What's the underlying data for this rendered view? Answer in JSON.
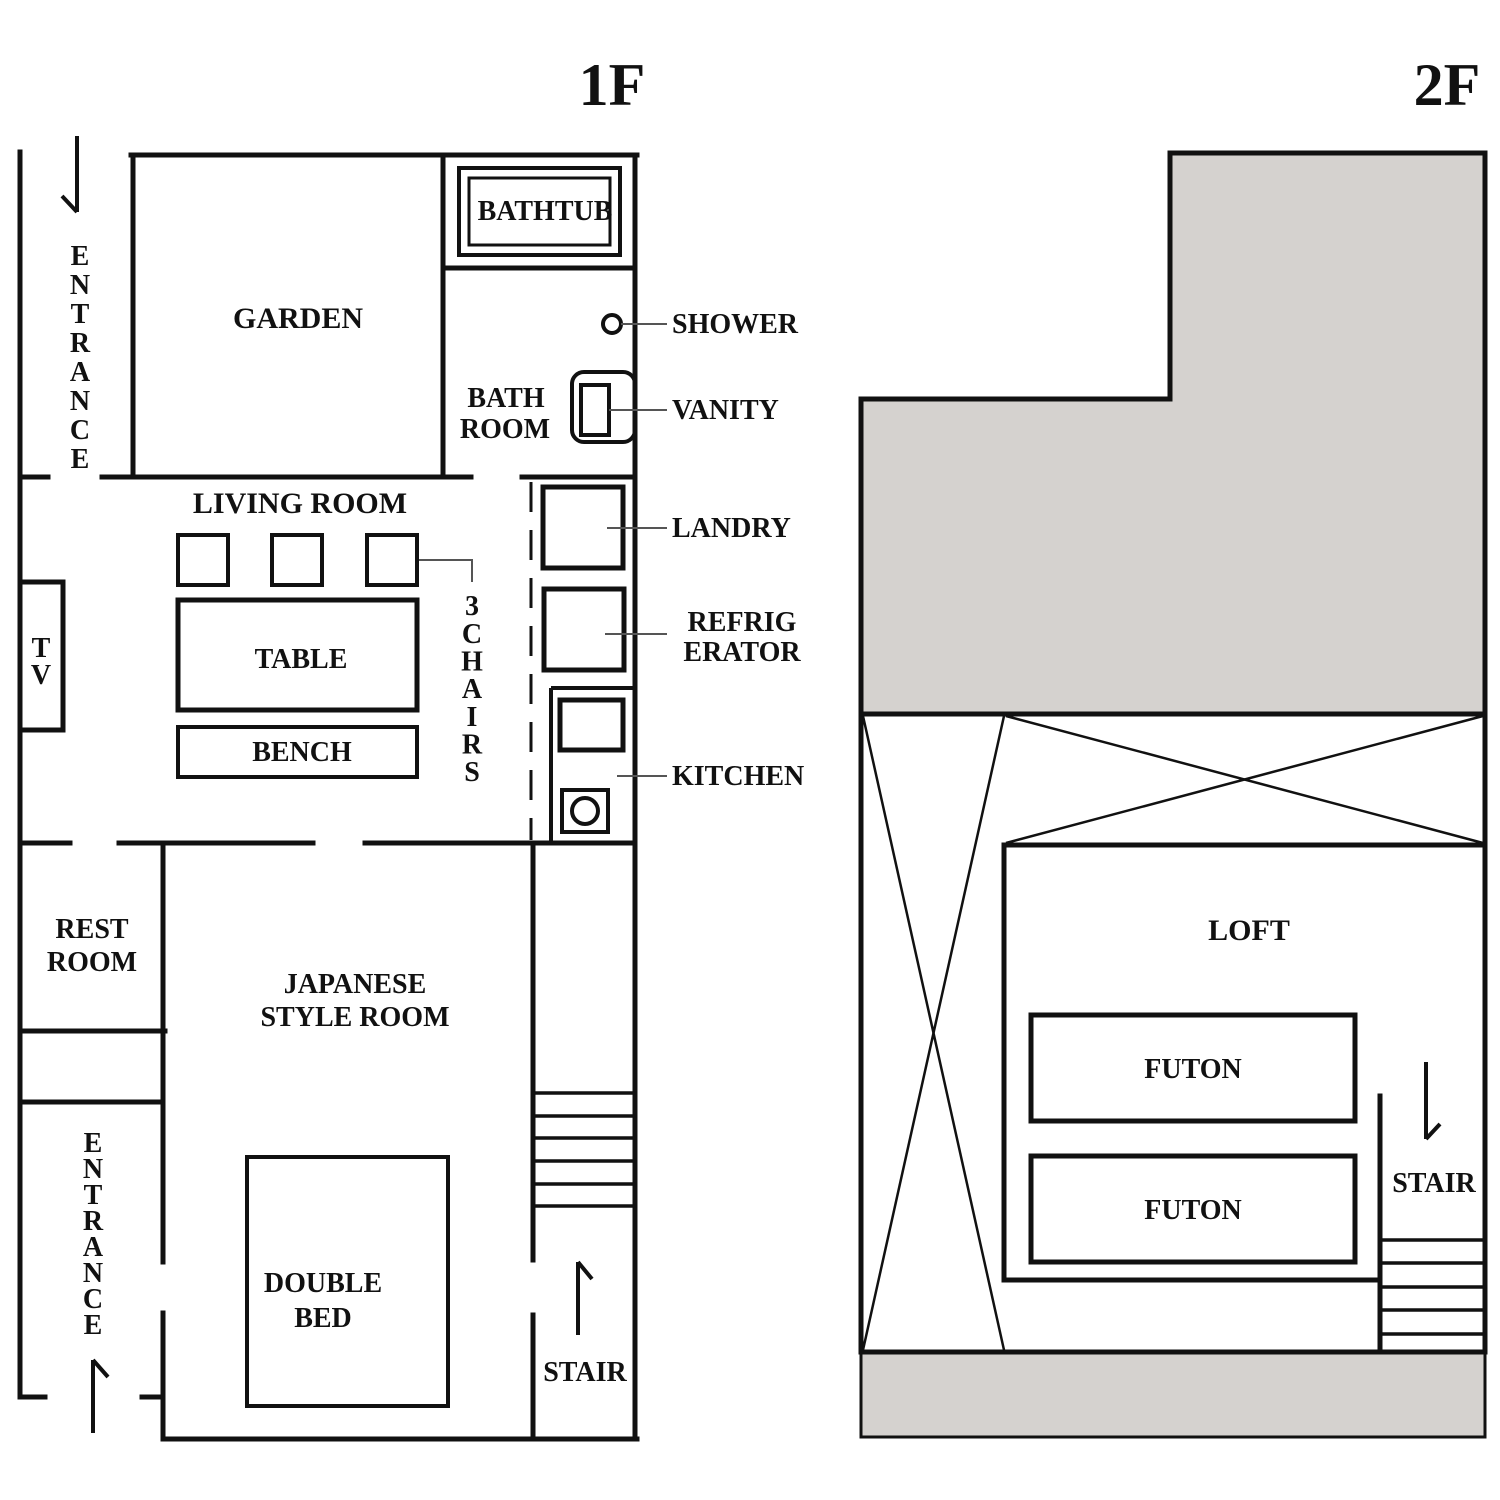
{
  "titles": {
    "floor1": "1F",
    "floor2": "2F"
  },
  "colors": {
    "wall": "#111111",
    "roof_gray": "#d5d2cf",
    "leader": "#555555",
    "background": "#ffffff"
  },
  "floor1": {
    "rooms": {
      "garden": "GARDEN",
      "living_room": "LIVING ROOM",
      "bath_line1": "BATH",
      "bath_line2": "ROOM",
      "rest_line1": "REST",
      "rest_line2": "ROOM",
      "japanese_line1": "JAPANESE",
      "japanese_line2": "STYLE ROOM"
    },
    "furniture": {
      "bathtub": "BATHTUB",
      "table": "TABLE",
      "bench": "BENCH",
      "tv": "TV",
      "bed_line1": "DOUBLE",
      "bed_line2": "BED"
    },
    "callouts": {
      "shower": "SHOWER",
      "vanity": "VANITY",
      "laundry": "LANDRY",
      "refrigerator_line1": "REFRIG",
      "refrigerator_line2": "ERATOR",
      "kitchen": "KITCHEN",
      "chairs_count": "3",
      "chairs_word": "CHAIRS"
    },
    "entrance_top": "ENTRANCE",
    "entrance_bottom": "ENTRANCE",
    "stair": "STAIR"
  },
  "floor2": {
    "loft": "LOFT",
    "futon_upper": "FUTON",
    "futon_lower": "FUTON",
    "stair": "STAIR"
  }
}
